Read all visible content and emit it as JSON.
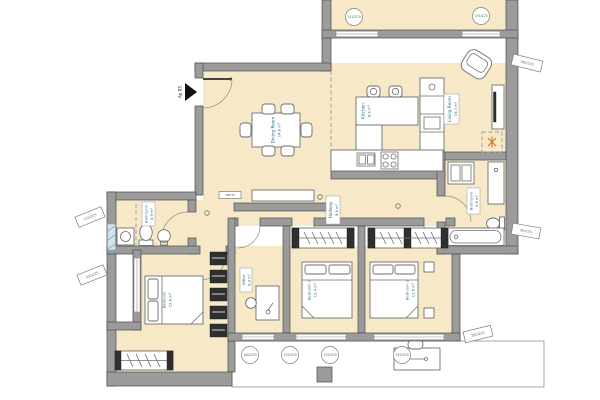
{
  "plan_title": "Apartment floor plan",
  "unit": {
    "label": "Ap 05"
  },
  "colors": {
    "floor": "#f7e9c8",
    "wall": "#9b9b9b",
    "wall_outline": "#4c4c4c",
    "label_text": "#2e6e86",
    "tag_text": "#3f7a52",
    "accent": "#c87a2e",
    "window_blue": "#cfe4ee"
  },
  "rooms": {
    "dining": {
      "name": "Dining Room",
      "area": "14.6 m²"
    },
    "kitchen": {
      "name": "Kitchen",
      "area": "8.6 m²"
    },
    "living": {
      "name": "Living Room",
      "area": "19.3 m²"
    },
    "hallway": {
      "name": "Hallway",
      "area": "9.8 m²"
    },
    "bathroom_1": {
      "name": "Bathroom",
      "area": "4.9 m²"
    },
    "bathroom_2": {
      "name": "Bathroom",
      "area": "5.6 m²"
    },
    "office": {
      "name": "Office",
      "area": "4.9 m²"
    },
    "bedroom_1": {
      "name": "Bedroom 1",
      "area": "12.4 m²"
    },
    "bedroom_2": {
      "name": "Bedroom 2",
      "area": "13.6 m²"
    },
    "master_bedroom": {
      "name": "Bedroom",
      "area": "15.8 m²"
    }
  },
  "window_tags": {
    "top_1": "141/225",
    "top_2": "135/225",
    "bottom_1": "160/225",
    "bottom_2": "135/225",
    "bottom_3": "135/225",
    "bottom_4": "135/225",
    "left_1": "110/225",
    "left_2": "100/225",
    "right_1": "280/225",
    "right_2": "80/225",
    "right_3": "180/225",
    "beam": "180/70"
  }
}
